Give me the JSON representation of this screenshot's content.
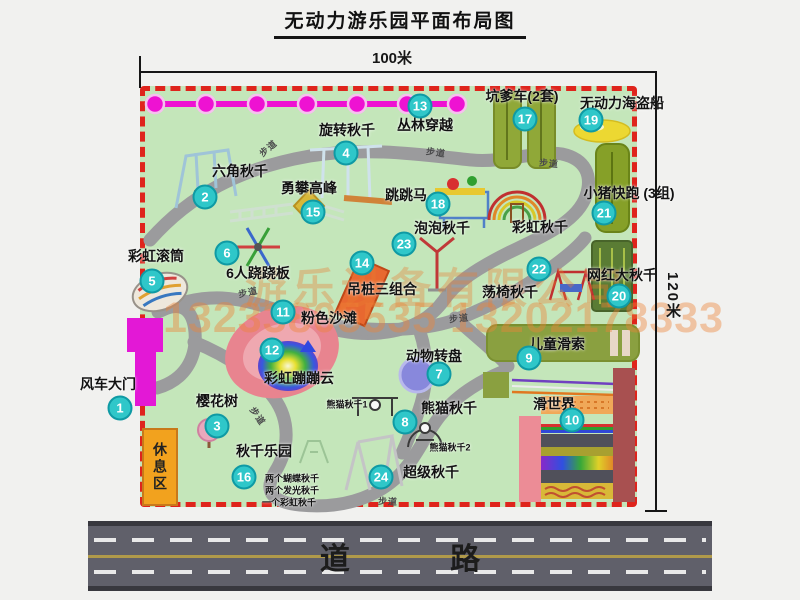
{
  "title": "无动力游乐园平面布局图",
  "dims": {
    "width": "100米",
    "height": "120米"
  },
  "road": {
    "label": "道 路"
  },
  "watermark": {
    "company": "游乐设备有限公司",
    "phone": "13233805535 13202178333"
  },
  "rest_area": {
    "label": "休息区"
  },
  "map": {
    "facilities": [
      {
        "num": 1,
        "name": "风车大门",
        "label": [
          108,
          384
        ],
        "badge": [
          120,
          408
        ]
      },
      {
        "num": 2,
        "name": "六角秋千",
        "label": [
          240,
          171
        ],
        "badge": [
          205,
          197
        ]
      },
      {
        "num": 3,
        "name": "樱花树",
        "label": [
          217,
          401
        ],
        "badge": [
          217,
          426
        ]
      },
      {
        "num": 4,
        "name": "旋转秋千",
        "label": [
          347,
          130
        ],
        "badge": [
          346,
          153
        ]
      },
      {
        "num": 5,
        "name": "彩虹滚筒",
        "label": [
          156,
          256
        ],
        "badge": [
          152,
          281
        ]
      },
      {
        "num": 6,
        "name": "6人跷跷板",
        "label": [
          258,
          273
        ],
        "badge": [
          227,
          253
        ]
      },
      {
        "num": 7,
        "name": "动物转盘",
        "label": [
          434,
          356
        ],
        "badge": [
          439,
          374
        ]
      },
      {
        "num": 8,
        "name": "熊猫秋千",
        "label": [
          449,
          408
        ],
        "badge": [
          405,
          422
        ]
      },
      {
        "num": 9,
        "name": "儿童滑索",
        "label": [
          557,
          344
        ],
        "badge": [
          529,
          358
        ]
      },
      {
        "num": 10,
        "name": "滑世界",
        "label": [
          554,
          404
        ],
        "badge": [
          572,
          420
        ]
      },
      {
        "num": 11,
        "name": "粉色沙滩",
        "label": [
          329,
          318
        ],
        "badge": [
          283,
          312
        ]
      },
      {
        "num": 12,
        "name": "彩虹蹦蹦云",
        "label": [
          299,
          378
        ],
        "badge": [
          272,
          350
        ]
      },
      {
        "num": 13,
        "name": "丛林穿越",
        "label": [
          425,
          125
        ],
        "badge": [
          420,
          106
        ]
      },
      {
        "num": 14,
        "name": "吊桩三组合",
        "label": [
          382,
          289
        ],
        "badge": [
          362,
          263
        ]
      },
      {
        "num": 15,
        "name": "勇攀高峰",
        "label": [
          309,
          188
        ],
        "badge": [
          313,
          212
        ]
      },
      {
        "num": 16,
        "name": "秋千乐园",
        "label": [
          264,
          451
        ],
        "badge": [
          244,
          477
        ]
      },
      {
        "num": 17,
        "name": "坑爹车(2套)",
        "label": [
          522,
          96
        ],
        "badge": [
          525,
          119
        ]
      },
      {
        "num": 18,
        "name": "跳跳马",
        "label": [
          406,
          195
        ],
        "badge": [
          438,
          204
        ]
      },
      {
        "num": 19,
        "name": "无动力海盗船",
        "label": [
          622,
          103
        ],
        "badge": [
          591,
          120
        ]
      },
      {
        "num": 20,
        "name": "网红大秋千",
        "label": [
          622,
          275
        ],
        "badge": [
          619,
          296
        ]
      },
      {
        "num": 21,
        "name": "小猪快跑 (3组)",
        "label": [
          629,
          193
        ],
        "badge": [
          604,
          213
        ]
      },
      {
        "num": 22,
        "name": "荡椅秋千",
        "label": [
          510,
          292
        ],
        "badge": [
          539,
          269
        ]
      },
      {
        "num": 23,
        "name": "泡泡秋千",
        "label": [
          442,
          228
        ],
        "badge": [
          404,
          244
        ]
      },
      {
        "num": 24,
        "name": "超级秋千",
        "label": [
          431,
          472
        ],
        "badge": [
          381,
          477
        ]
      }
    ],
    "extra_labels": [
      {
        "text": "彩虹秋千",
        "x": 540,
        "y": 227,
        "size": 14
      },
      {
        "text": "熊猫秋千1",
        "x": 347,
        "y": 404,
        "size": 9
      },
      {
        "text": "熊猫秋千2",
        "x": 450,
        "y": 447,
        "size": 9
      },
      {
        "text": "两个蝴蝶秋千",
        "x": 292,
        "y": 478,
        "size": 9
      },
      {
        "text": "两个发光秋千",
        "x": 292,
        "y": 490,
        "size": 9
      },
      {
        "text": "一个彩虹秋千",
        "x": 289,
        "y": 502,
        "size": 9
      }
    ],
    "path_labels": [
      {
        "text": "步道",
        "x": 268,
        "y": 148,
        "r": -40
      },
      {
        "text": "步道",
        "x": 436,
        "y": 152,
        "r": 8
      },
      {
        "text": "步道",
        "x": 549,
        "y": 163,
        "r": 5
      },
      {
        "text": "步道",
        "x": 459,
        "y": 318,
        "r": -6
      },
      {
        "text": "步道",
        "x": 248,
        "y": 292,
        "r": -12
      },
      {
        "text": "步道",
        "x": 388,
        "y": 501,
        "r": 3
      },
      {
        "text": "步道",
        "x": 258,
        "y": 416,
        "r": 55
      }
    ]
  }
}
